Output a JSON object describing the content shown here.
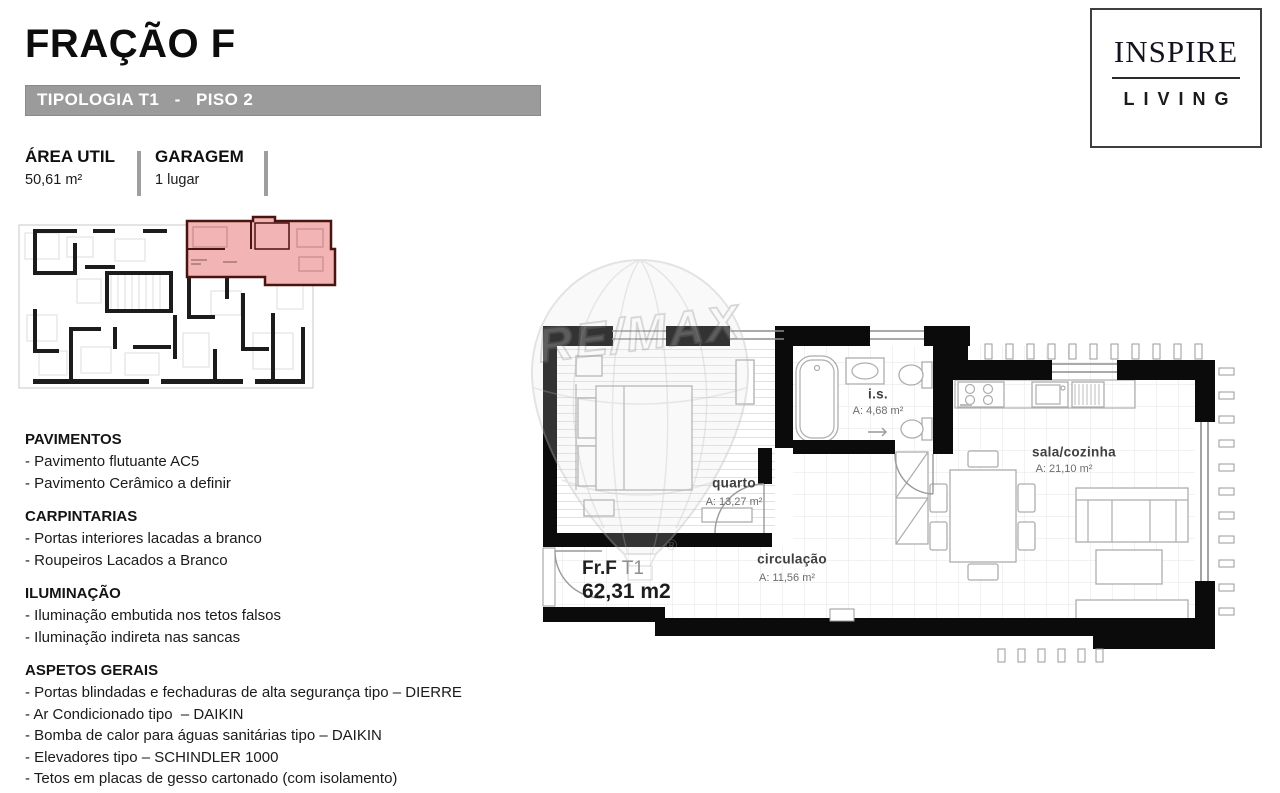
{
  "page": {
    "title": "FRAÇÃO F",
    "subtitle_bar": "TIPOLOGIA T1   -   PISO 2"
  },
  "brand": {
    "line1": "INSPIRE",
    "line2": "LIVING"
  },
  "summary": {
    "area_label": "ÁREA UTIL",
    "area_value": "50,61 m²",
    "garage_label": "GARAGEM",
    "garage_value": "1 lugar"
  },
  "floor_plan": {
    "unit_label": "Fr.F",
    "unit_type": " T1",
    "unit_area": "62,31 m2",
    "watermark": "RE/MAX",
    "watermark_reg": "®",
    "rooms": [
      {
        "name": "quarto",
        "area": "A: 13,27 m²"
      },
      {
        "name": "i.s.",
        "area": "A: 4,68 m²"
      },
      {
        "name": "sala/cozinha",
        "area": "A: 21,10 m²"
      },
      {
        "name": "circulação",
        "area": "A: 11,56 m²"
      }
    ]
  },
  "features": {
    "sections": [
      {
        "title": "PAVIMENTOS",
        "items": [
          "- Pavimento flutuante AC5",
          "- Pavimento Cerâmico a definir"
        ]
      },
      {
        "title": "CARPINTARIAS",
        "items": [
          "- Portas interiores lacadas a branco",
          "- Roupeiros Lacados a Branco"
        ]
      },
      {
        "title": "ILUMINAÇÃO",
        "items": [
          "- Iluminação embutida nos tetos falsos",
          "- Iluminação indireta nas sancas"
        ]
      },
      {
        "title": "ASPETOS GERAIS",
        "items": [
          "- Portas blindadas e fechaduras de alta segurança tipo – DIERRE",
          "- Ar Condicionado tipo  – DAIKIN",
          "- Bomba de calor para águas sanitárias tipo – DAIKIN",
          "- Elevadores tipo – SCHINDLER 1000",
          "- Tetos em placas de gesso cartonado (com isolamento)"
        ]
      }
    ]
  },
  "colors": {
    "highlight_fill": "#f2b4b4",
    "highlight_wall": "#4a1410",
    "bar_gray": "#9b9b9b"
  }
}
